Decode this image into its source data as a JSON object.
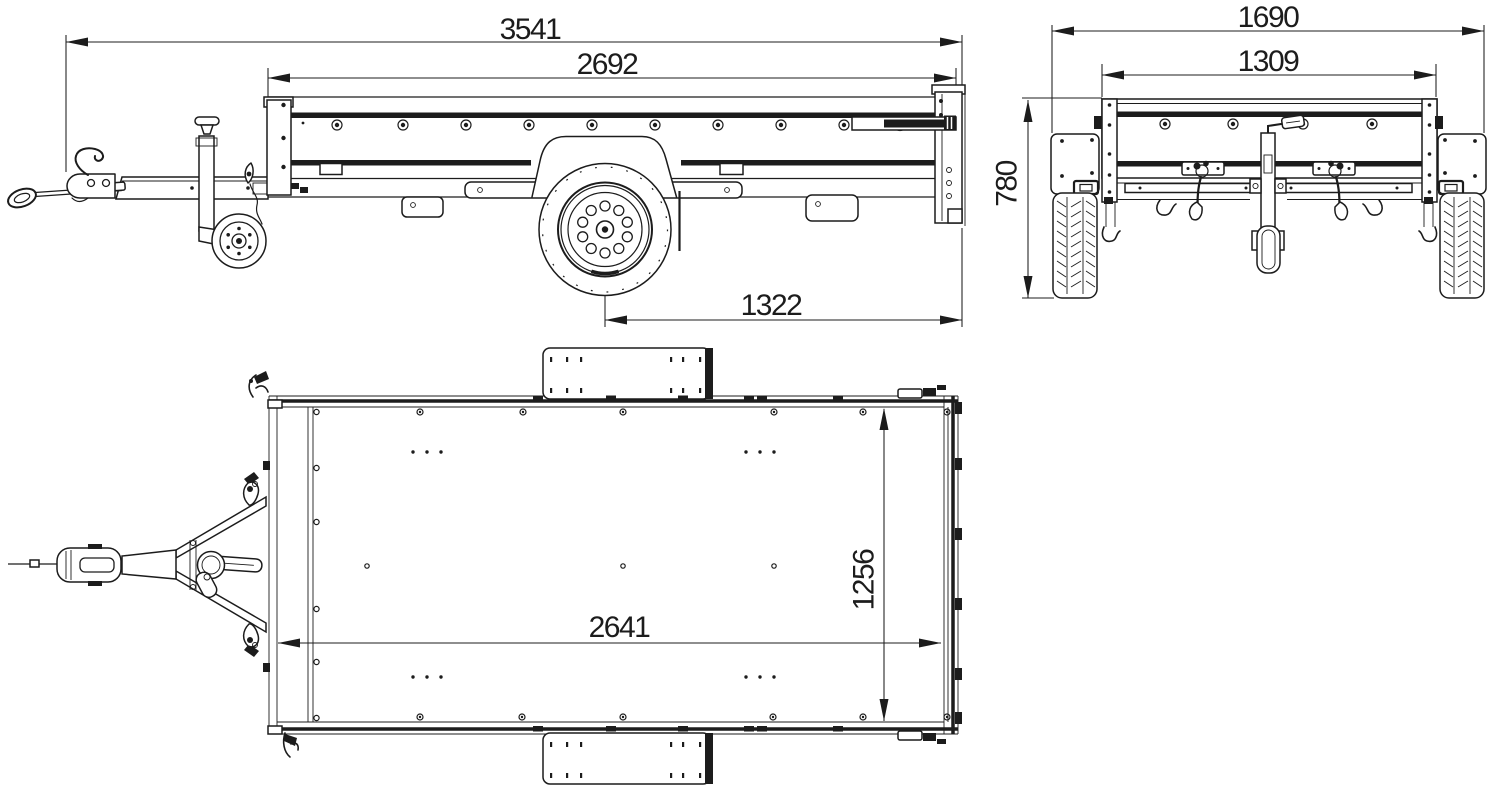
{
  "colors": {
    "background": "#ffffff",
    "line": "#1c1c1c"
  },
  "views": {
    "side": {
      "overall_length": "3541",
      "bed_length": "2692",
      "axle_to_rear": "1322"
    },
    "rear": {
      "overall_width": "1690",
      "body_width": "1309",
      "height": "780"
    },
    "top": {
      "bed_length": "2641",
      "bed_width": "1256"
    }
  }
}
